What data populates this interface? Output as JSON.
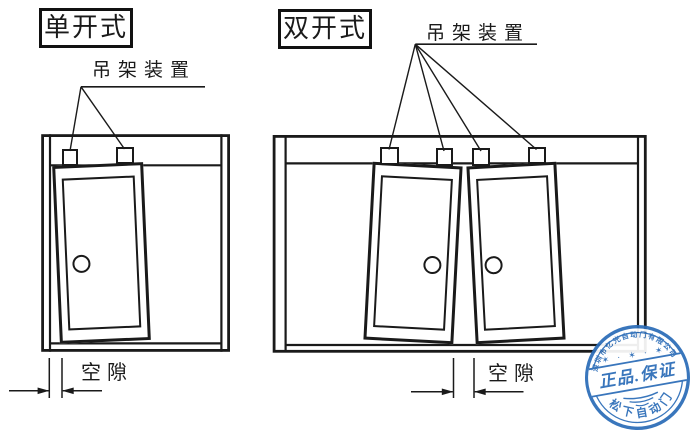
{
  "panels": {
    "single": {
      "title": "单开式",
      "hanger_label": "吊架装置",
      "gap_label": "空隙"
    },
    "double": {
      "title": "双开式",
      "hanger_label": "吊架装置",
      "gap_label": "空隙"
    }
  },
  "stamp": {
    "top_arc_text": "深圳市亿光自动门有限公司",
    "center_text": "正品.保证",
    "bottom_arc_text": "松下自动门",
    "stars": "✶ · ✶ · ✶",
    "blue": "#2b6cb8"
  },
  "colors": {
    "line": "#1a1a1a",
    "background": "#ffffff"
  }
}
